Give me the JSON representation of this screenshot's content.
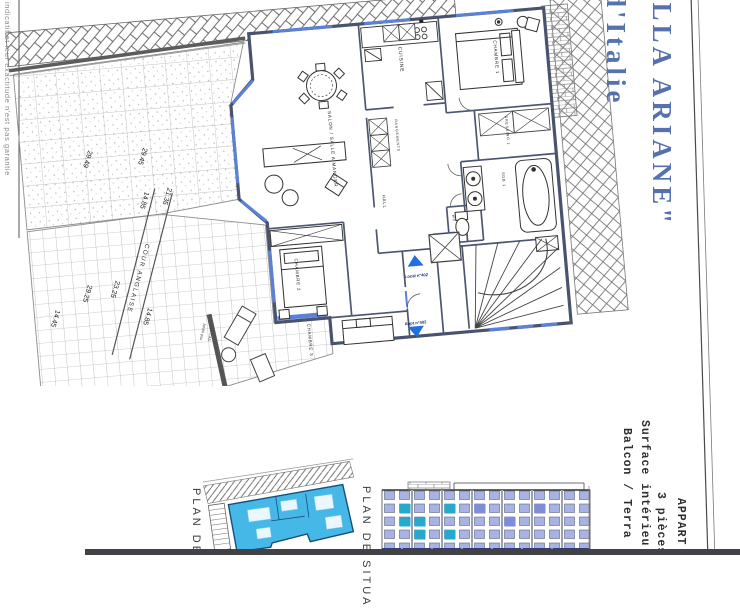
{
  "title": {
    "line1": "ILLA ARIANE\"",
    "line2": "d'Italie",
    "color": "#5672ae"
  },
  "disclaimer": "indicatif et leur exactitude n'est pas garantie",
  "info_block": {
    "line1": "APPART",
    "line2": "3 pièces",
    "line3": "Surface intérieu",
    "line4": "Balcon / Terra"
  },
  "plan": {
    "rooms": {
      "salon": "SALON / SALLE A MANGER",
      "cuisine": "CUISINE",
      "chambre1": "CHAMBRE 1",
      "dressing1": "DRESSING 1",
      "sdb1": "SDB 1",
      "wc": "WC",
      "hall": "HALL",
      "rangements": "RANGEMENTS",
      "chambre2": "CHAMBRE 2",
      "chambre3": "CHAMBRE 3"
    },
    "areas": {
      "cour_anglaise": "COUR ANGLAISE",
      "jardin_l1": "Jardin pou",
      "jardin_l2": "\"LE CAS"
    },
    "dimensions": [
      "29.49",
      "29.45",
      "21.35",
      "14.85",
      "29.25",
      "23.25",
      "14.85",
      "14.45"
    ],
    "access": {
      "up_label": "Local n°402",
      "down_label": "Appt n°402"
    },
    "colors": {
      "arrow": "#1f6fe0",
      "window": "#5b82d8",
      "wall": "#49536e"
    }
  },
  "mini_plans": {
    "left_label": "PLAN DE",
    "right_label": "PLAN DE SITUA",
    "apartment_fill": "#45b8e8",
    "facade_window": "#a9b2e4",
    "facade_highlight": "#26a9cc"
  }
}
